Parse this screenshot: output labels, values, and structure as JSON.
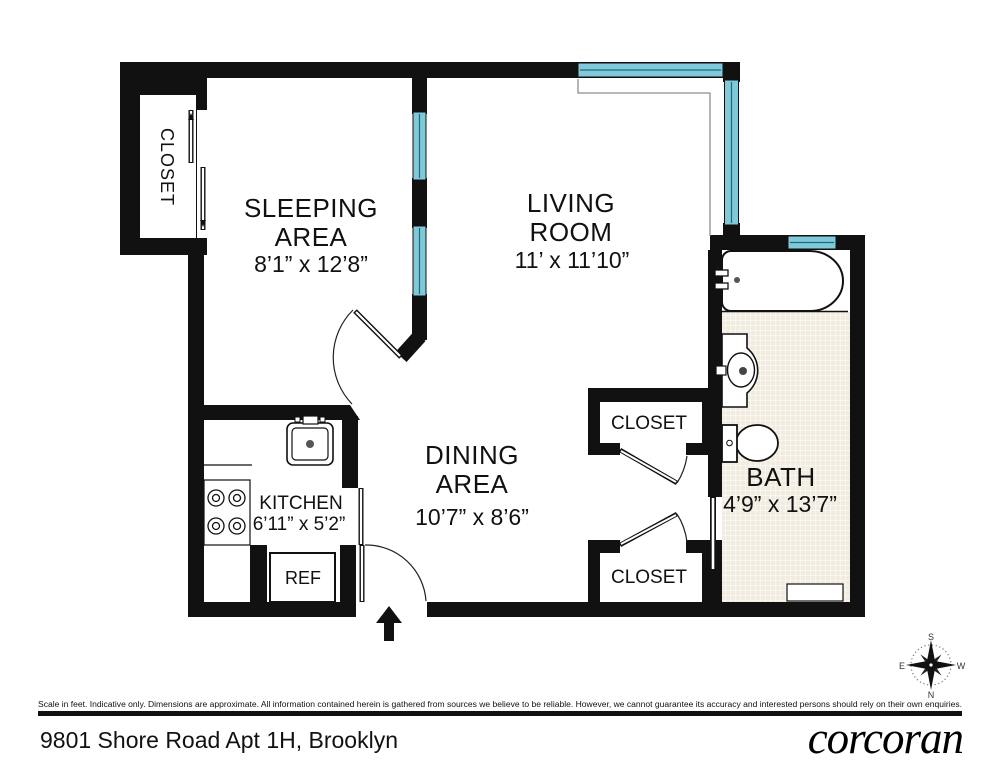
{
  "title_block": {
    "address": "9801 Shore Road Apt 1H, Brooklyn",
    "brand_logo": "corcoran",
    "disclaimer": "Scale in feet. Indicative only. Dimensions are approximate. All information contained herein is gathered from sources we believe to be reliable. However, we cannot guarantee its accuracy and interested persons should rely on their own enquiries."
  },
  "rooms": {
    "sleeping_area": {
      "line1": "SLEEPING",
      "line2": "AREA",
      "dims": "8’1” x 12’8”"
    },
    "living_room": {
      "line1": "LIVING",
      "line2": "ROOM",
      "dims": "11’ x 11’10”"
    },
    "dining_area": {
      "line1": "DINING",
      "line2": "AREA",
      "dims": "10’7” x 8’6”"
    },
    "kitchen": {
      "line1": "KITCHEN",
      "dims": "6’11” x 5’2”"
    },
    "bath": {
      "line1": "BATH",
      "dims": "4’9” x 13’7”"
    },
    "closet_sleeping": {
      "line1": "CLOSET"
    },
    "closet_upper": {
      "line1": "CLOSET"
    },
    "closet_lower": {
      "line1": "CLOSET"
    },
    "refrigerator": {
      "line1": "REF"
    }
  },
  "compass": {
    "top": "S",
    "bottom": "N",
    "left": "E",
    "right": "W"
  },
  "colors": {
    "wall": "#111111",
    "window_glass": "#7fc9d9",
    "window_frame": "#1d6b7d",
    "bath_tile": "#f2ebdf",
    "background": "#ffffff"
  },
  "fixtures": [
    "bathtub",
    "pedestal-sink",
    "toilet",
    "kitchen-sink",
    "four-burner-stove",
    "refrigerator",
    "hinged-doors",
    "sliding-doors",
    "casement-windows",
    "entry-arrow",
    "compass-rose"
  ]
}
